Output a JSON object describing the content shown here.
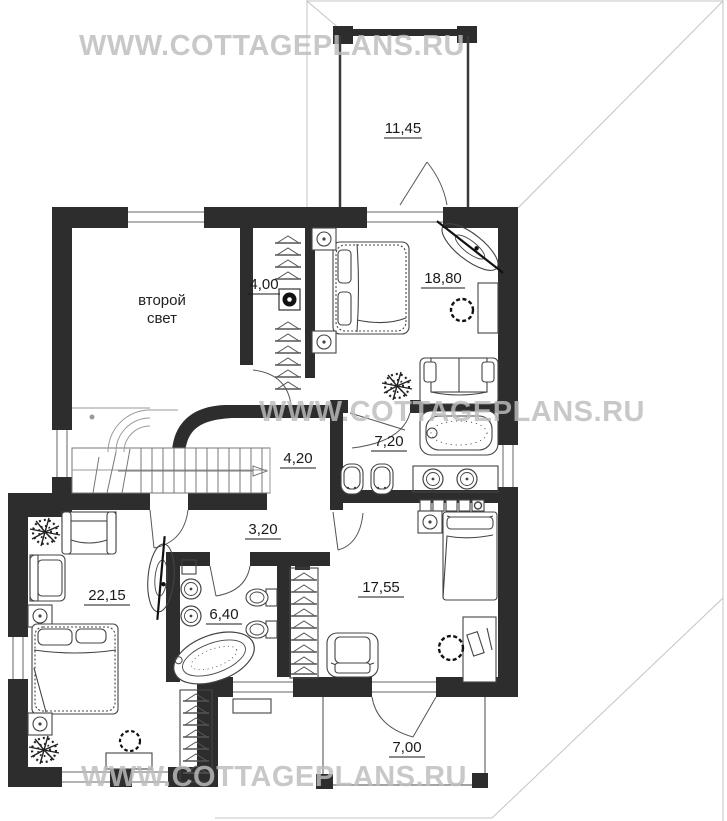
{
  "watermark": {
    "text": "WWW.COTTAGEPLANS.RU"
  },
  "rooms": {
    "balcony": {
      "area": "11,45"
    },
    "wardrobe": {
      "area": "4,00"
    },
    "bedroom_top": {
      "area": "18,80"
    },
    "second_light": {
      "line1": "второй",
      "line2": "свет"
    },
    "bathroom_top": {
      "area": "7,20"
    },
    "hall": {
      "area": "4,20"
    },
    "corridor": {
      "area": "3,20"
    },
    "bedroom_left": {
      "area": "22,15"
    },
    "bathroom_bottom": {
      "area": "6,40"
    },
    "bedroom_right": {
      "area": "17,55"
    },
    "terrace": {
      "area": "7,00"
    }
  },
  "colors": {
    "wall": "#2d2d2d",
    "furniture_line": "#444444",
    "roof_line": "#c4c4c4",
    "watermark": "#bdbdbd",
    "label": "#1a1a1a"
  }
}
